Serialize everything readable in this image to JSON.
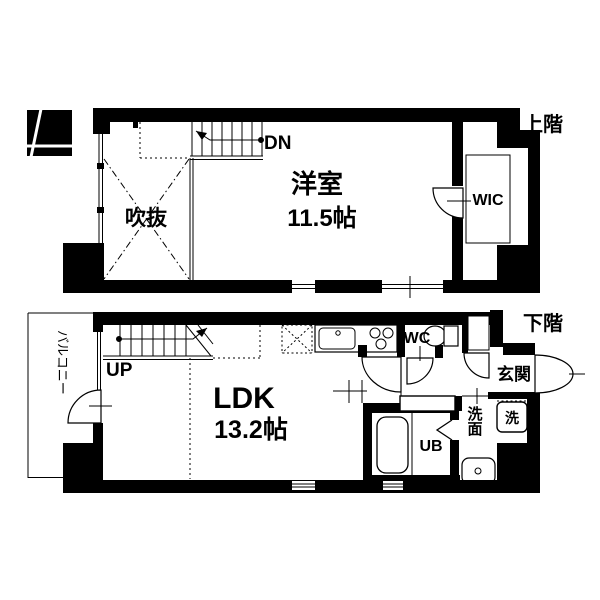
{
  "colors": {
    "ink": "#000000",
    "paper": "#ffffff"
  },
  "upper_floor": {
    "floor_label": "上階",
    "compass_label": "N",
    "bedroom_label": "洋室",
    "bedroom_size": "11.5帖",
    "void_label": "吹抜",
    "wic_label": "WIC",
    "stairs_label": "DN"
  },
  "lower_floor": {
    "floor_label": "下階",
    "ldk_label": "LDK",
    "ldk_size": "13.2帖",
    "balcony_label": "バルコニー",
    "stairs_label": "UP",
    "wc_label": "WC",
    "entrance_label": "玄関",
    "laundry_label": "洗",
    "washroom_label": "洗面",
    "bath_label": "UB"
  }
}
